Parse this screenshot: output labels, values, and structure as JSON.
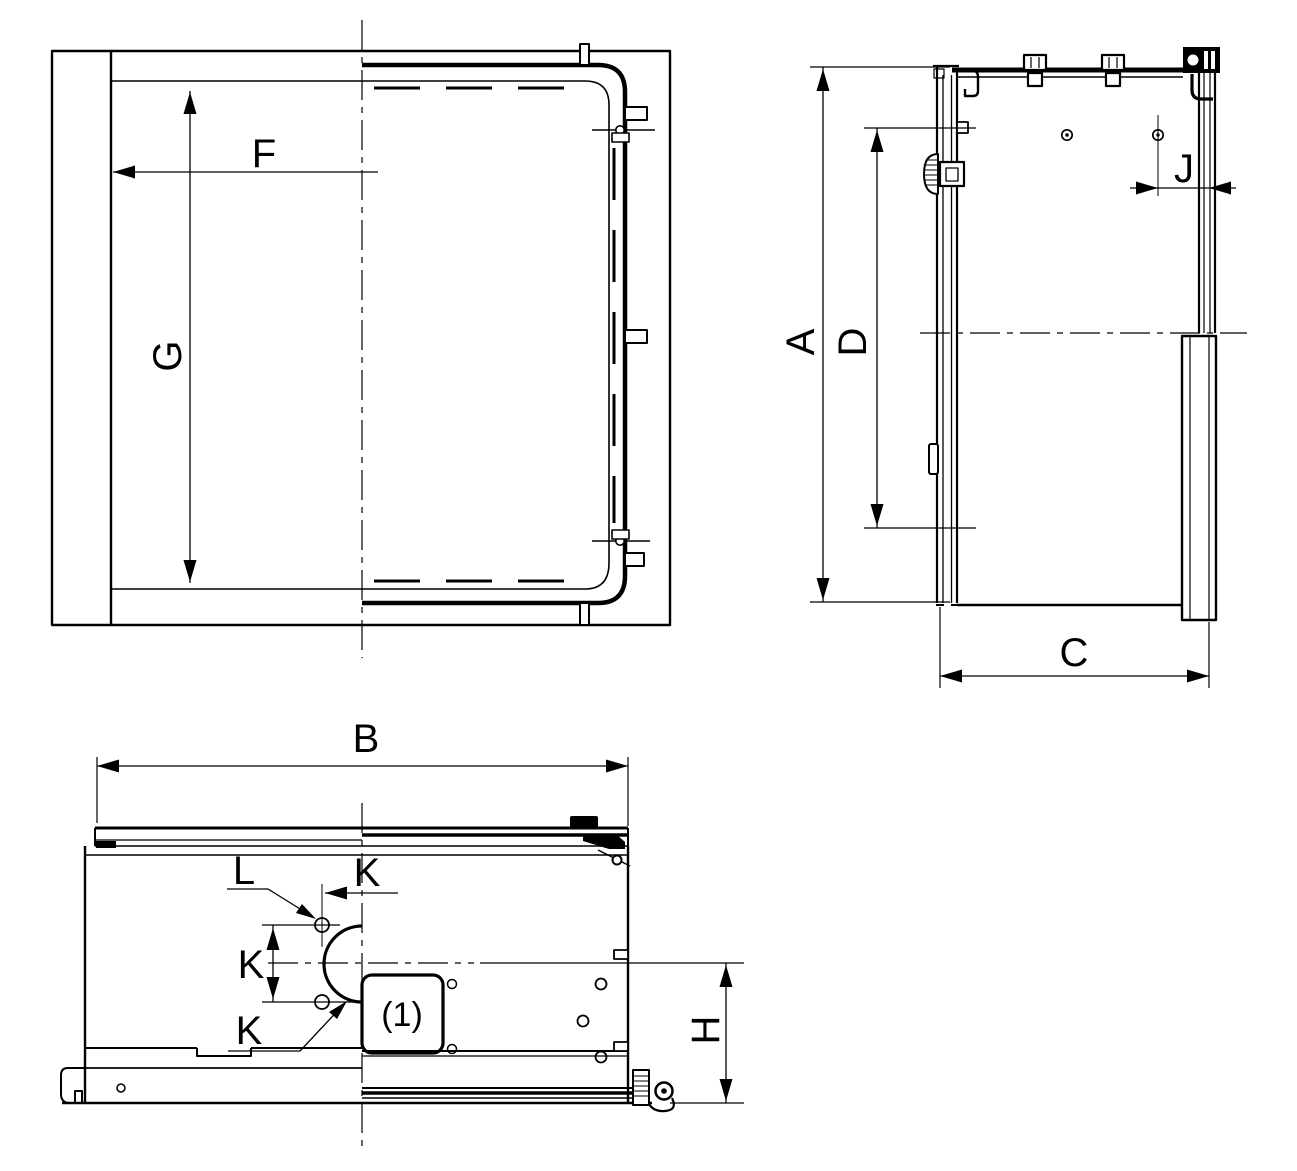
{
  "drawing": {
    "background_color": "#ffffff",
    "line_color": "#000000",
    "views": {
      "top_view": {
        "name": "top view",
        "dims": {
          "F": "F",
          "G": "G"
        }
      },
      "side_view": {
        "name": "side view",
        "dims": {
          "A": "A",
          "D": "D",
          "J": "J",
          "C": "C"
        }
      },
      "bottom_view": {
        "name": "bottom view",
        "dims": {
          "B": "B",
          "H": "H",
          "K": "K",
          "L": "L"
        },
        "callout_1": "(1)"
      }
    }
  }
}
